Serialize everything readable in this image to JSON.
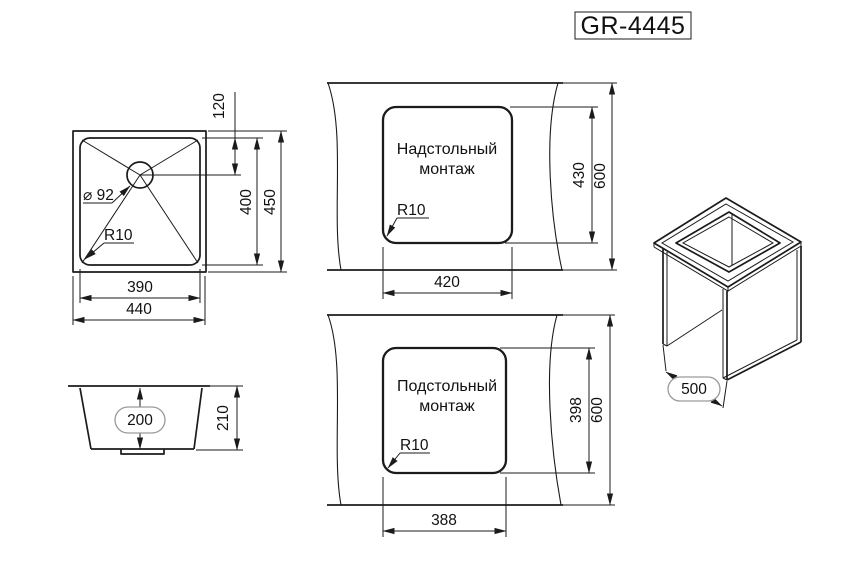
{
  "title": "GR-4445",
  "top_view": {
    "overall_width": "440",
    "bowl_width": "390",
    "overall_depth": "450",
    "bowl_depth": "400",
    "drain_offset": "120",
    "drain_diameter": "⌀ 92",
    "corner_radius": "R10"
  },
  "side_view": {
    "bowl_height": "200",
    "overall_height": "210"
  },
  "overmount_view": {
    "label_line1": "Надстольный",
    "label_line2": "монтаж",
    "cutout_width": "420",
    "cutout_depth": "430",
    "countertop_depth": "600",
    "corner_radius": "R10"
  },
  "undermount_view": {
    "label_line1": "Подстольный",
    "label_line2": "монтаж",
    "cutout_width": "388",
    "cutout_depth": "398",
    "countertop_depth": "600",
    "corner_radius": "R10"
  },
  "iso_view": {
    "cabinet_width": "500"
  }
}
